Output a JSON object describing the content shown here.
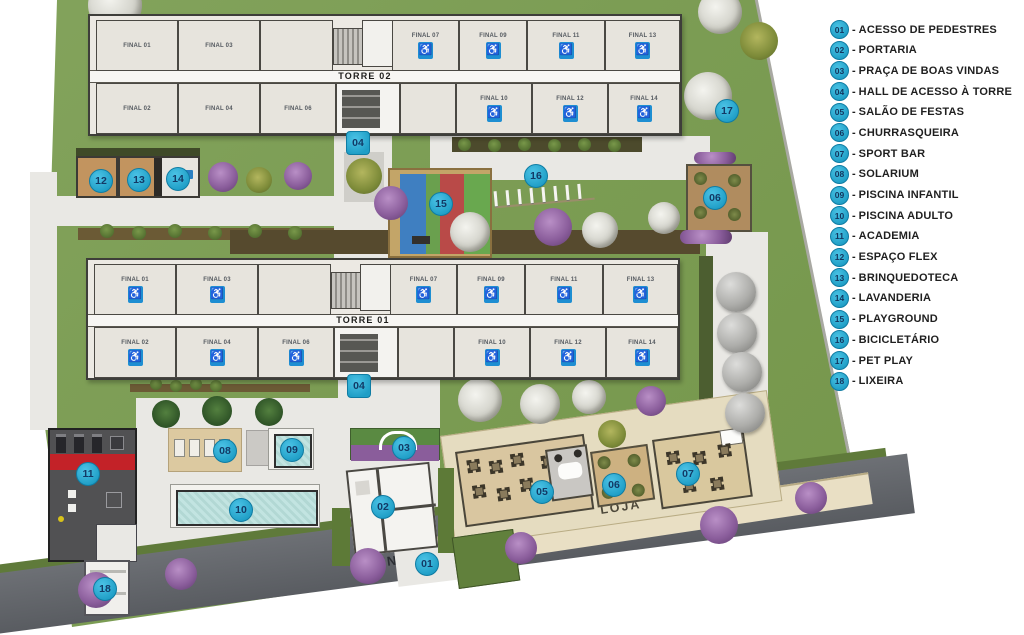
{
  "legend": {
    "separator": "-",
    "items": [
      {
        "num": "01",
        "label": "ACESSO DE PEDESTRES"
      },
      {
        "num": "02",
        "label": "PORTARIA"
      },
      {
        "num": "03",
        "label": "PRAÇA DE BOAS VINDAS"
      },
      {
        "num": "04",
        "label": "HALL DE ACESSO À TORRE"
      },
      {
        "num": "05",
        "label": "SALÃO DE FESTAS"
      },
      {
        "num": "06",
        "label": "CHURRASQUEIRA"
      },
      {
        "num": "07",
        "label": "SPORT BAR"
      },
      {
        "num": "08",
        "label": "SOLARIUM"
      },
      {
        "num": "09",
        "label": "PISCINA INFANTIL"
      },
      {
        "num": "10",
        "label": "PISCINA ADULTO"
      },
      {
        "num": "11",
        "label": "ACADEMIA"
      },
      {
        "num": "12",
        "label": "ESPAÇO FLEX"
      },
      {
        "num": "13",
        "label": "BRINQUEDOTECA"
      },
      {
        "num": "14",
        "label": "LAVANDERIA"
      },
      {
        "num": "15",
        "label": "PLAYGROUND"
      },
      {
        "num": "16",
        "label": "BICICLETÁRIO"
      },
      {
        "num": "17",
        "label": "PET PLAY"
      },
      {
        "num": "18",
        "label": "LIXEIRA"
      }
    ]
  },
  "street": {
    "name": "AVENIDA PAULA FERREIRA"
  },
  "shop_label": "LOJA",
  "accessible_icon": "♿",
  "towers": [
    {
      "name": "TORRE 02",
      "x": 88,
      "y": 14,
      "rooms": [
        {
          "label": "FINAL 01",
          "x": 6,
          "y": 4,
          "w": 82,
          "h": 51,
          "icon": false
        },
        {
          "label": "FINAL 03",
          "x": 88,
          "y": 4,
          "w": 82,
          "h": 51,
          "icon": false
        },
        {
          "label": "",
          "x": 170,
          "y": 4,
          "w": 73,
          "h": 51,
          "icon": false
        },
        {
          "label": "FINAL 07",
          "x": 302,
          "y": 4,
          "w": 67,
          "h": 51,
          "icon": true
        },
        {
          "label": "FINAL 09",
          "x": 369,
          "y": 4,
          "w": 68,
          "h": 51,
          "icon": true
        },
        {
          "label": "FINAL 11",
          "x": 437,
          "y": 4,
          "w": 78,
          "h": 51,
          "icon": true
        },
        {
          "label": "FINAL 13",
          "x": 515,
          "y": 4,
          "w": 75,
          "h": 51,
          "icon": true
        },
        {
          "label": "FINAL 02",
          "x": 6,
          "y": 67,
          "w": 82,
          "h": 51,
          "icon": false
        },
        {
          "label": "FINAL 04",
          "x": 88,
          "y": 67,
          "w": 82,
          "h": 51,
          "icon": false
        },
        {
          "label": "FINAL 06",
          "x": 170,
          "y": 67,
          "w": 76,
          "h": 51,
          "icon": false
        },
        {
          "label": "",
          "x": 310,
          "y": 67,
          "w": 56,
          "h": 51,
          "icon": false
        },
        {
          "label": "FINAL 10",
          "x": 366,
          "y": 67,
          "w": 76,
          "h": 51,
          "icon": true
        },
        {
          "label": "FINAL 12",
          "x": 442,
          "y": 67,
          "w": 76,
          "h": 51,
          "icon": true
        },
        {
          "label": "FINAL 14",
          "x": 518,
          "y": 67,
          "w": 72,
          "h": 51,
          "icon": true
        }
      ]
    },
    {
      "name": "TORRE 01",
      "x": 86,
      "y": 258,
      "rooms": [
        {
          "label": "FINAL 01",
          "x": 6,
          "y": 4,
          "w": 82,
          "h": 51,
          "icon": true
        },
        {
          "label": "FINAL 03",
          "x": 88,
          "y": 4,
          "w": 82,
          "h": 51,
          "icon": true
        },
        {
          "label": "",
          "x": 170,
          "y": 4,
          "w": 73,
          "h": 51,
          "icon": false
        },
        {
          "label": "FINAL 07",
          "x": 302,
          "y": 4,
          "w": 67,
          "h": 51,
          "icon": true
        },
        {
          "label": "FINAL 09",
          "x": 369,
          "y": 4,
          "w": 68,
          "h": 51,
          "icon": true
        },
        {
          "label": "FINAL 11",
          "x": 437,
          "y": 4,
          "w": 78,
          "h": 51,
          "icon": true
        },
        {
          "label": "FINAL 13",
          "x": 515,
          "y": 4,
          "w": 75,
          "h": 51,
          "icon": true
        },
        {
          "label": "FINAL 02",
          "x": 6,
          "y": 67,
          "w": 82,
          "h": 51,
          "icon": true
        },
        {
          "label": "FINAL 04",
          "x": 88,
          "y": 67,
          "w": 82,
          "h": 51,
          "icon": true
        },
        {
          "label": "FINAL 06",
          "x": 170,
          "y": 67,
          "w": 76,
          "h": 51,
          "icon": true
        },
        {
          "label": "",
          "x": 310,
          "y": 67,
          "w": 56,
          "h": 51,
          "icon": false
        },
        {
          "label": "FINAL 10",
          "x": 366,
          "y": 67,
          "w": 76,
          "h": 51,
          "icon": true
        },
        {
          "label": "FINAL 12",
          "x": 442,
          "y": 67,
          "w": 76,
          "h": 51,
          "icon": true
        },
        {
          "label": "FINAL 14",
          "x": 518,
          "y": 67,
          "w": 72,
          "h": 51,
          "icon": true
        }
      ]
    }
  ],
  "plan_badges": [
    {
      "num": "04",
      "x": 357,
      "y": 142,
      "shape": "square"
    },
    {
      "num": "04",
      "x": 358,
      "y": 385,
      "shape": "square"
    },
    {
      "num": "12",
      "x": 100,
      "y": 180
    },
    {
      "num": "13",
      "x": 138,
      "y": 179
    },
    {
      "num": "14",
      "x": 177,
      "y": 178
    },
    {
      "num": "15",
      "x": 440,
      "y": 203
    },
    {
      "num": "16",
      "x": 535,
      "y": 175
    },
    {
      "num": "17",
      "x": 726,
      "y": 110
    },
    {
      "num": "06",
      "x": 714,
      "y": 197
    },
    {
      "num": "11",
      "x": 87,
      "y": 473
    },
    {
      "num": "18",
      "x": 104,
      "y": 588
    },
    {
      "num": "08",
      "x": 224,
      "y": 450
    },
    {
      "num": "09",
      "x": 291,
      "y": 449
    },
    {
      "num": "10",
      "x": 240,
      "y": 509
    },
    {
      "num": "03",
      "x": 403,
      "y": 447
    },
    {
      "num": "02",
      "x": 382,
      "y": 506
    },
    {
      "num": "01",
      "x": 426,
      "y": 563
    },
    {
      "num": "05",
      "x": 541,
      "y": 491
    },
    {
      "num": "06",
      "x": 613,
      "y": 484
    },
    {
      "num": "07",
      "x": 687,
      "y": 473
    }
  ],
  "colors": {
    "badge": "#2fb3dc",
    "badge_text": "#123a66",
    "accessible_blue": "#1e8ed2",
    "pool_water": "#bfe2df",
    "street_gray": "#63666b",
    "grass_green": "#7b9c53",
    "academy_red": "#c32228"
  }
}
